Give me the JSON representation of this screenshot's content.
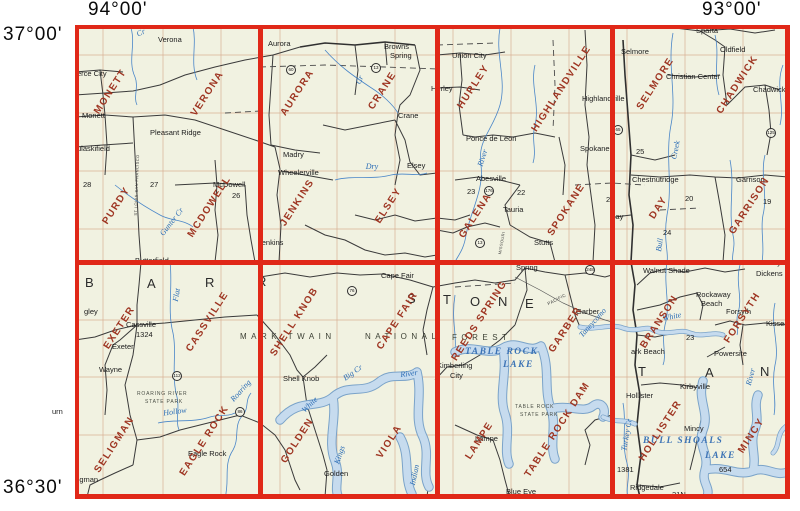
{
  "corners": {
    "top_left": "94°00'",
    "top_right": "93°00'",
    "left_top": "37°00'",
    "left_bottom": "36°30'"
  },
  "colors": {
    "grid_red": "#e02818",
    "quad_name_red": "#9e3522",
    "water_blue": "#2a6cb5",
    "map_background": "#f1f2e1"
  },
  "grid": {
    "cells": [
      {
        "quads": [
          "MONETT",
          "VERONA",
          "PURDY",
          "MCDOWELL"
        ]
      },
      {
        "quads": [
          "AURORA",
          "CRANE",
          "JENKINS",
          "ELSEY"
        ]
      },
      {
        "quads": [
          "HURLEY",
          "HIGHLANDVILLE",
          "GALENA",
          "SPOKANE"
        ]
      },
      {
        "quads": [
          "SELMORE",
          "CHADWICK",
          "DAY",
          "GARRISON"
        ]
      },
      {
        "quads": [
          "EXETER",
          "CASSVILLE",
          "SELIGMAN",
          "EAGLE ROCK"
        ]
      },
      {
        "quads": [
          "SHELL KNOB",
          "CAPE FAIR",
          "GOLDEN",
          "VIOLA"
        ]
      },
      {
        "quads": [
          "REEDS SPRING",
          "GARBER",
          "LAMPE",
          "TABLE ROCK DAM"
        ]
      },
      {
        "quads": [
          "BRANSON",
          "FORSYTH",
          "HOLLISTER",
          "MINCY"
        ]
      }
    ]
  },
  "counties": {
    "barry": [
      "B",
      "A",
      "R",
      "R"
    ],
    "stone": [
      "S",
      "T",
      "O",
      "N",
      "E"
    ],
    "taney": [
      "T",
      "A",
      "N"
    ]
  },
  "forest": {
    "line1": "MARK TWAIN",
    "line2": "NATIONAL",
    "line3": "FOREST"
  },
  "parks": {
    "roaring_river_1": "ROARING RIVER",
    "roaring_river_2": "STATE PARK",
    "table_rock_1": "TABLE ROCK",
    "table_rock_2": "STATE PARK"
  },
  "lakes": {
    "table_rock_line1": "TABLE ROCK",
    "table_rock_line2": "LAKE",
    "bull_shoals_line1": "BULL SHOALS",
    "bull_shoals_line2": "LAKE",
    "taneycomo": "Taneycomo"
  },
  "waters": {
    "cr_top": "Cr",
    "gunter": "Gunter Cr",
    "crane_cr": "Cr",
    "dry": "Dry",
    "james_river": "River",
    "flat": "Flat",
    "white_upper": "White",
    "kings": "Kings",
    "indian": "Indian",
    "hollow": "Hollow",
    "roaring": "Roaring",
    "turkey": "Turkey Cr",
    "bull_creek": "Creek",
    "bull": "Bull",
    "white_east": "White",
    "river_east": "River",
    "river_mid": "River",
    "big_cr": "Big Cr"
  },
  "railroads": {
    "frisco": "ST LOUIS-SAN FRANCISCO",
    "pacific": "PACIFIC",
    "missouri": "MISSOURI"
  },
  "shields": {
    "s60": "60",
    "s13": "13",
    "s176": "176",
    "s86": "86",
    "s112": "112",
    "s76": "76",
    "s65": "65",
    "s125": "125",
    "s248": "248",
    "s13b": "13"
  },
  "numbers": {
    "n28": "28",
    "n27": "27",
    "n26": "26",
    "n25": "25",
    "n24": "24",
    "n23a": "23",
    "n22": "22",
    "n21": "21",
    "n20": "20",
    "n19": "19",
    "n23b": "23",
    "n1324": "1324",
    "n1381": "1381",
    "n654": "654",
    "n21n": "21N"
  },
  "towns": {
    "verona": "Verona",
    "pierce_city": "erce City",
    "monett": "Monett",
    "pleasant_ridge": "Pleasant Ridge",
    "pulaskifield": "ulaskifield",
    "mcdowell": "McDowell",
    "jenkins": "Jenkins",
    "aurora": "Aurora",
    "browns": "Browns",
    "browns2": "Spring",
    "madry": "Madry",
    "wheelerville": "Wheelerville",
    "elsey": "Elsey",
    "crane": "Crane",
    "union_city": "Union City",
    "hurley": "Hurley",
    "ponce_de_leon": "Ponce de Leon",
    "abesville": "Abesville",
    "tauria": "Tauria",
    "stutts": "Stutts",
    "spokane": "Spokane",
    "sparta": "Sparta",
    "selmore": "Selmore",
    "oldfield": "Oldfield",
    "christian_center": "Christian Center",
    "chadwick": "Chadwick",
    "highlandville": "Highlandville",
    "chestnutridge": "Chestnutridge",
    "garrison": "Garrison",
    "day": "Day",
    "butterfield": "Butterfield",
    "gley": "gley",
    "cassville": "Cassville",
    "exeter": "Exeter",
    "wayne": "Wayne",
    "cape_fair": "Cape Fair",
    "shell_knob": "Shell Knob",
    "spring": "Spring",
    "kimberling": "Kimberling",
    "kimberling2": "City",
    "garber": "Garber",
    "golden": "Golden",
    "eagle_rock": "Eagle Rock",
    "seligman": "ligman",
    "washburn": "urn",
    "lampe": "Lampe",
    "blue_eye": "Blue Eye",
    "walnut_shade": "Walnut Shade",
    "rockaway": "Rockaway",
    "rockaway2": "Beach",
    "forsyth": "Forsyth",
    "kissee": "Kissee",
    "powersite": "Powersite",
    "ozark_beach": "ark Beach",
    "hollister": "Hollister",
    "kirbyville": "Kirbyville",
    "mincy": "Mincy",
    "ridgedale": "Ridgedale",
    "taney": "Taney",
    "dickens": "Dickens"
  }
}
